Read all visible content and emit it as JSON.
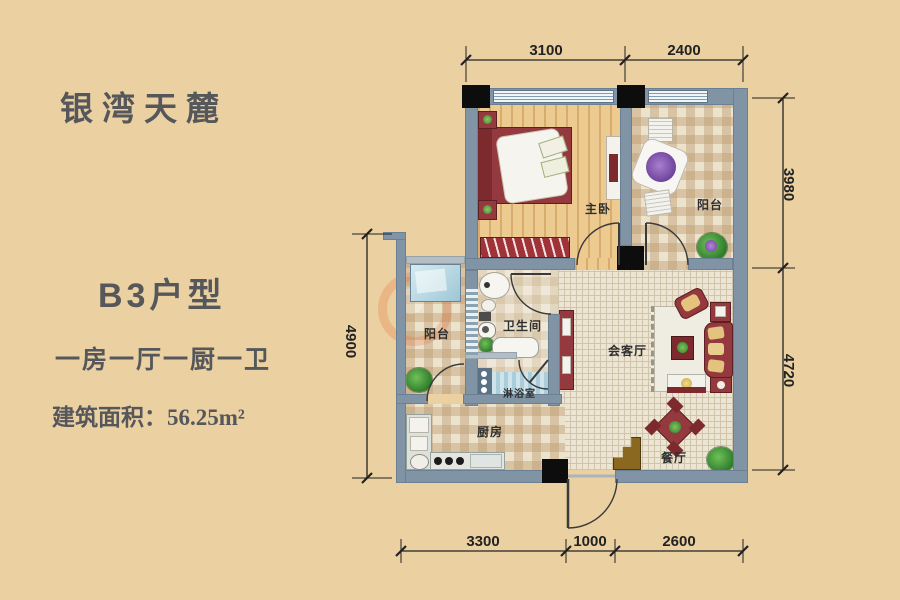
{
  "project": {
    "name": "银湾天麓",
    "unit_type": "B3户型",
    "layout_desc": "一房一厅一厨一卫",
    "area_text": "建筑面积：56.25m²"
  },
  "rooms": {
    "master_bedroom": "主卧",
    "balcony_top": "阳台",
    "balcony_left": "阳台",
    "bathroom": "卫生间",
    "shower_room": "淋浴室",
    "living_room": "会客厅",
    "kitchen": "厨房",
    "dining_room": "餐厅"
  },
  "dimensions": {
    "top": [
      "3100",
      "2400"
    ],
    "bottom": [
      "3300",
      "1000",
      "2600"
    ],
    "left": [
      "4900"
    ],
    "right": [
      "3980",
      "4720"
    ]
  },
  "colors": {
    "background": "#ebd0a1",
    "wall": "#8094a6",
    "column": "#0d0d0d",
    "wood_floor": "#ecca90",
    "tile": "#ece3cd",
    "furniture_accent": "#94393d",
    "text": "#55575b"
  }
}
